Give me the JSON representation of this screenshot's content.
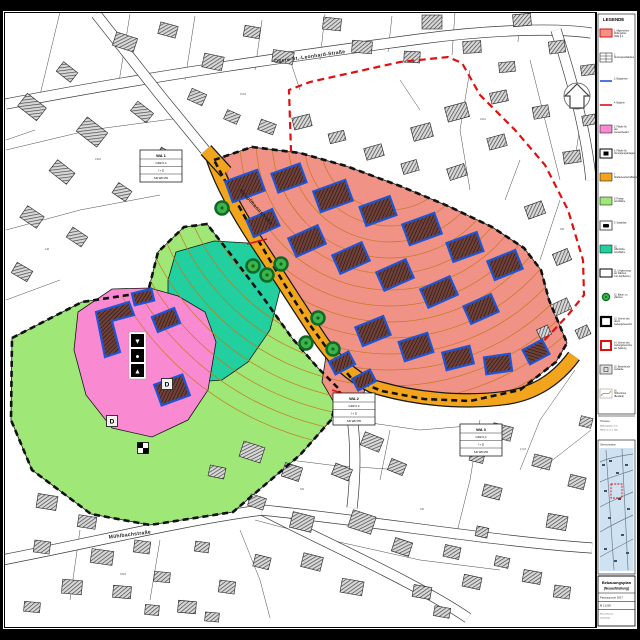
{
  "document": {
    "title": "Bebauungsplan",
    "subtitle": "(Neuaufstellung)",
    "version": "Fassung vom 2017",
    "scale": "M 1:1000",
    "footer": [
      "Planverfasser",
      "Gemeinde"
    ]
  },
  "legend": {
    "title": "LEGENDE",
    "items": [
      {
        "type": "wa",
        "label": "1. Allgemeines Wohngebiet (WA) § 4 BauNVO"
      },
      {
        "type": "table",
        "label": "2. Nutzungsschablone"
      },
      {
        "type": "blueline",
        "label": "3. Baugrenze"
      },
      {
        "type": "redline",
        "label": "4. Baulinie"
      },
      {
        "type": "pink",
        "label": "5. Fläche für den Gemeinbedarf"
      },
      {
        "type": "blackbox",
        "label": "6. Fläche für Versorgungsanlagen"
      },
      {
        "type": "orange",
        "label": "7. Straßenverkehrsfläche"
      },
      {
        "type": "green",
        "label": "8. Private Grünfläche"
      },
      {
        "type": "playbox",
        "label": "9. Spielplatz"
      },
      {
        "type": "teal",
        "label": "10. Öffentliche Grünfläche"
      },
      {
        "type": "whitebox",
        "label": "11. Umgrenzung der Flächen zum Anpflanzen"
      },
      {
        "type": "tree",
        "label": "12. Baum, zu pflanzen"
      },
      {
        "type": "blackframe",
        "label": "13. Grenze des räuml. Geltungsbereichs"
      },
      {
        "type": "redframe",
        "label": "14. Grenze des Geltungsbereichs der Satzung"
      },
      {
        "type": "graybox",
        "label": "15. Bestehende Gebäude"
      },
      {
        "type": "contour",
        "label": "16. Höhenlinien (Bestand)"
      }
    ]
  },
  "notes": {
    "lines": [
      "Hinweise:",
      "Maßangaben in m.",
      "Höhen in m ü. NN."
    ]
  },
  "overview": {
    "title": "Übersichtsplan"
  },
  "map": {
    "colors": {
      "wa": "#f19286",
      "pink": "#f98ad2",
      "green": "#9fe878",
      "teal": "#22cf9e",
      "road": "#f2a51c",
      "contour": "#c8761c",
      "building_outline": "#1e55d6",
      "building_fill": "#6e4038",
      "existing_fill": "#d8d8d8",
      "boundary_black": "#111111",
      "boundary_red": "#dd1111",
      "tree_fill": "#3db34a",
      "tree_ring": "#0c6b26",
      "overview_bg": "#cfe2f2"
    },
    "streets": [
      {
        "name": "Obere-St.-Leonhard-Straße",
        "x": 310,
        "y": 58,
        "rot": -8
      },
      {
        "name": "Hauptmannstraße",
        "x": 255,
        "y": 208,
        "rot": 48
      },
      {
        "name": "Mühlbachstraße",
        "x": 130,
        "y": 536,
        "rot": -7
      }
    ],
    "wa_tables": [
      {
        "label": "WA 1",
        "rows": [
          "GRZ 0,4",
          "I + D",
          "SD WD PD"
        ],
        "x": 140,
        "y": 150
      },
      {
        "label": "WA 2",
        "rows": [
          "GRZ 0,4",
          "I + D",
          "SD WD PD"
        ],
        "x": 333,
        "y": 393
      },
      {
        "label": "WA 3",
        "rows": [
          "GRZ 0,4",
          "I + D",
          "SD WD PD"
        ],
        "x": 460,
        "y": 424
      }
    ],
    "d_labels": [
      {
        "t": "D",
        "x": 112,
        "y": 421
      },
      {
        "t": "D",
        "x": 167,
        "y": 384
      }
    ],
    "parcel_labels": [
      {
        "t": "146/2",
        "x": 95,
        "y": 160
      },
      {
        "t": "148",
        "x": 45,
        "y": 250
      },
      {
        "t": "151/3",
        "x": 240,
        "y": 95
      },
      {
        "t": "162/1",
        "x": 480,
        "y": 120
      },
      {
        "t": "168",
        "x": 560,
        "y": 230
      },
      {
        "t": "171/2",
        "x": 520,
        "y": 450
      },
      {
        "t": "329",
        "x": 300,
        "y": 490
      },
      {
        "t": "333/4",
        "x": 120,
        "y": 575
      },
      {
        "t": "340",
        "x": 420,
        "y": 510
      },
      {
        "t": "155",
        "x": 30,
        "y": 330
      }
    ],
    "symbols": {
      "utility_glyphs": [
        "▼",
        "●",
        "▲"
      ],
      "utility_x": 131,
      "utility_y": 334,
      "checker_x": 143,
      "checker_y": 448
    },
    "zones": [
      {
        "name": "gruenflaeche",
        "color": "green",
        "contours": true,
        "points": "12,338 82,302 148,292 158,252 184,227 207,224 232,256 262,296 292,338 318,368 340,390 331,420 300,455 233,512 150,525 91,514 32,470 11,420"
      },
      {
        "name": "oeffentliche-gruenflaeche",
        "color": "teal",
        "contours": false,
        "points": "176,252 214,241 248,243 272,258 280,290 270,330 248,362 222,380 196,382 176,360 168,318 168,280"
      },
      {
        "name": "gemeinbedarf",
        "color": "pink",
        "contours": false,
        "points": "78,312 112,289 150,288 178,296 205,312 216,342 208,390 188,420 152,437 112,428 86,395 74,350"
      },
      {
        "name": "wohngebiet",
        "color": "wa",
        "contours": true,
        "points": "214,160 252,147 300,153 346,166 400,186 448,206 492,227 524,248 541,270 549,300 567,343 556,362 520,390 470,401 424,399 382,391 352,379 331,354 310,325 291,295 271,262 251,228 231,192"
      },
      {
        "name": "wohngebiet-sued",
        "color": "wa",
        "contours": true,
        "points": "326,356 355,372 366,382 362,404 336,406 322,382"
      }
    ],
    "orange_road": [
      "M 213,159 C 222,185 238,214 258,244 C 278,274 298,306 322,342 C 338,364 352,376 372,386 C 410,398 460,404 505,398 C 535,394 558,378 574,356",
      "M 206,150 L 226,172"
    ],
    "base_roads": [
      "M 6,104 C 150,76 300,55 420,39 C 480,31 550,27 591,33",
      "M 96,14 L 160,95 L 205,150",
      "M 556,30 C 572,80 586,130 591,180",
      "M 2,560 C 100,541 180,521 262,510 C 330,545 420,585 468,618",
      "M 262,510 C 380,522 500,542 592,548",
      "M 346,380 C 354,420 358,455 352,508"
    ],
    "boundary_black": [
      "214,160 252,147 300,153 346,166 400,186 448,206 492,227 524,248 541,270 549,300 567,343 556,362 520,390 470,401 424,399 382,391 352,379 331,354 310,325 291,295 271,262 251,228 231,192",
      "12,338 82,302 148,292 158,252 184,227 207,224 232,256 262,296 292,338 318,368 340,390 331,420 300,455 233,512 150,525 91,514 32,470 11,420"
    ],
    "boundary_red": "M 291,152 L 289,90 L 310,82 L 355,72 L 400,62 L 448,57 L 462,63 L 480,95 L 515,130 L 545,165 L 568,210 L 583,260 L 584,295 L 568,315 L 552,332 L 540,345",
    "red_lines": [
      [
        247,
        244,
        267,
        239
      ],
      [
        332,
        390,
        350,
        396
      ]
    ],
    "proposed_buildings": [
      [
        245,
        186,
        34,
        22,
        -20
      ],
      [
        289,
        178,
        30,
        20,
        -20
      ],
      [
        333,
        196,
        34,
        22,
        -20
      ],
      [
        378,
        211,
        32,
        20,
        -20
      ],
      [
        422,
        229,
        34,
        22,
        -20
      ],
      [
        465,
        247,
        32,
        20,
        -20
      ],
      [
        505,
        265,
        30,
        20,
        -22
      ],
      [
        263,
        223,
        28,
        18,
        -24
      ],
      [
        307,
        241,
        32,
        20,
        -24
      ],
      [
        351,
        258,
        32,
        20,
        -24
      ],
      [
        395,
        275,
        32,
        20,
        -24
      ],
      [
        439,
        292,
        32,
        20,
        -24
      ],
      [
        481,
        309,
        30,
        19,
        -24
      ],
      [
        373,
        331,
        30,
        20,
        -22
      ],
      [
        416,
        347,
        30,
        20,
        -18
      ],
      [
        458,
        358,
        28,
        18,
        -14
      ],
      [
        498,
        364,
        26,
        17,
        -8
      ],
      [
        536,
        352,
        16,
        22,
        62
      ],
      [
        342,
        363,
        22,
        14,
        -28
      ],
      [
        364,
        380,
        20,
        13,
        -28
      ],
      [
        143,
        297,
        20,
        12,
        -14
      ],
      [
        166,
        320,
        24,
        16,
        -22
      ],
      [
        172,
        390,
        30,
        22,
        -20
      ]
    ],
    "proposed_polys": [
      "96,312 129,302 134,315 112,321 120,352 105,357"
    ],
    "trees": [
      [
        222,
        208
      ],
      [
        253,
        266
      ],
      [
        267,
        275
      ],
      [
        281,
        264
      ],
      [
        318,
        318
      ],
      [
        306,
        343
      ],
      [
        333,
        349
      ]
    ],
    "existing_buildings": [
      [
        125,
        42,
        22,
        14,
        18
      ],
      [
        168,
        30,
        18,
        12,
        15
      ],
      [
        213,
        62,
        20,
        14,
        12
      ],
      [
        252,
        32,
        16,
        11,
        10
      ],
      [
        283,
        57,
        21,
        12,
        8
      ],
      [
        332,
        24,
        18,
        12,
        6
      ],
      [
        362,
        47,
        20,
        12,
        5
      ],
      [
        412,
        57,
        16,
        11,
        3
      ],
      [
        432,
        22,
        20,
        14,
        0
      ],
      [
        472,
        47,
        18,
        12,
        -3
      ],
      [
        507,
        67,
        16,
        10,
        -5
      ],
      [
        522,
        20,
        18,
        12,
        -5
      ],
      [
        557,
        47,
        16,
        12,
        -8
      ],
      [
        588,
        70,
        14,
        10,
        -8
      ],
      [
        32,
        107,
        24,
        16,
        38
      ],
      [
        67,
        72,
        18,
        12,
        38
      ],
      [
        92,
        132,
        26,
        18,
        38
      ],
      [
        142,
        112,
        20,
        12,
        38
      ],
      [
        62,
        172,
        22,
        14,
        38
      ],
      [
        32,
        217,
        20,
        14,
        34
      ],
      [
        77,
        237,
        18,
        12,
        34
      ],
      [
        122,
        192,
        16,
        12,
        34
      ],
      [
        22,
        272,
        18,
        12,
        30
      ],
      [
        165,
        155,
        14,
        10,
        30
      ],
      [
        197,
        97,
        16,
        12,
        24
      ],
      [
        232,
        117,
        14,
        10,
        24
      ],
      [
        267,
        127,
        16,
        11,
        20
      ],
      [
        302,
        122,
        18,
        12,
        -14
      ],
      [
        337,
        137,
        16,
        10,
        -14
      ],
      [
        374,
        152,
        18,
        12,
        -16
      ],
      [
        410,
        167,
        16,
        11,
        -16
      ],
      [
        422,
        132,
        20,
        14,
        -15
      ],
      [
        457,
        172,
        18,
        12,
        -18
      ],
      [
        457,
        112,
        22,
        15,
        -15
      ],
      [
        497,
        142,
        18,
        12,
        -15
      ],
      [
        499,
        97,
        17,
        11,
        -12
      ],
      [
        541,
        112,
        16,
        12,
        -10
      ],
      [
        572,
        157,
        17,
        12,
        -8
      ],
      [
        589,
        120,
        13,
        10,
        -10
      ],
      [
        535,
        210,
        18,
        13,
        -20
      ],
      [
        562,
        257,
        16,
        12,
        -22
      ],
      [
        561,
        307,
        18,
        12,
        -25
      ],
      [
        583,
        332,
        13,
        10,
        -25
      ],
      [
        544,
        332,
        12,
        10,
        -25
      ],
      [
        502,
        432,
        20,
        14,
        14
      ],
      [
        542,
        462,
        18,
        12,
        14
      ],
      [
        577,
        482,
        16,
        12,
        14
      ],
      [
        492,
        492,
        18,
        12,
        14
      ],
      [
        557,
        522,
        20,
        14,
        10
      ],
      [
        586,
        422,
        12,
        10,
        14
      ],
      [
        477,
        457,
        14,
        10,
        14
      ],
      [
        532,
        577,
        18,
        12,
        10
      ],
      [
        562,
        592,
        16,
        12,
        8
      ],
      [
        502,
        562,
        14,
        10,
        12
      ],
      [
        252,
        452,
        22,
        16,
        18
      ],
      [
        292,
        472,
        18,
        14,
        18
      ],
      [
        257,
        502,
        16,
        12,
        18
      ],
      [
        302,
        522,
        22,
        16,
        14
      ],
      [
        342,
        472,
        18,
        12,
        22
      ],
      [
        372,
        442,
        20,
        14,
        22
      ],
      [
        397,
        467,
        16,
        12,
        22
      ],
      [
        362,
        522,
        24,
        18,
        18
      ],
      [
        402,
        547,
        18,
        14,
        18
      ],
      [
        312,
        562,
        20,
        14,
        14
      ],
      [
        262,
        562,
        16,
        12,
        14
      ],
      [
        352,
        587,
        22,
        14,
        10
      ],
      [
        422,
        592,
        18,
        12,
        10
      ],
      [
        452,
        552,
        16,
        12,
        12
      ],
      [
        442,
        612,
        16,
        10,
        10
      ],
      [
        472,
        582,
        18,
        12,
        12
      ],
      [
        482,
        532,
        12,
        10,
        12
      ],
      [
        47,
        502,
        20,
        14,
        9
      ],
      [
        87,
        522,
        18,
        12,
        9
      ],
      [
        42,
        547,
        16,
        12,
        8
      ],
      [
        102,
        557,
        22,
        14,
        8
      ],
      [
        142,
        547,
        16,
        12,
        8
      ],
      [
        72,
        587,
        20,
        14,
        5
      ],
      [
        122,
        592,
        18,
        12,
        5
      ],
      [
        162,
        577,
        16,
        10,
        5
      ],
      [
        32,
        607,
        16,
        10,
        5
      ],
      [
        187,
        607,
        18,
        12,
        5
      ],
      [
        202,
        547,
        14,
        10,
        8
      ],
      [
        227,
        587,
        16,
        12,
        8
      ],
      [
        152,
        610,
        14,
        10,
        5
      ],
      [
        217,
        472,
        16,
        11,
        12
      ],
      [
        212,
        617,
        14,
        9,
        5
      ]
    ],
    "parcel_lines": [
      "60,12 40,95",
      "130,14 118,88",
      "195,16 185,80",
      "262,20 255,70",
      "325,14 320,60",
      "392,16 388,52",
      "455,12 452,55",
      "520,14 518,42",
      "6,150 90,130 180,118",
      "6,230 80,210 160,195",
      "6,300 60,280",
      "470,70 460,130 470,190",
      "530,60 545,120 560,180",
      "585,90 575,160",
      "560,200 540,260",
      "575,370 540,420 520,470",
      "591,430 540,470",
      "480,420 470,480 455,540",
      "390,430 380,480",
      "240,530 260,580 270,618",
      "160,540 150,600",
      "80,530 70,600",
      "350,420 420,430 480,425",
      "250,455 330,465 400,470",
      "255,520 330,540 420,560 500,570",
      "35,130 6,140",
      "210,240 180,260",
      "420,110 400,80",
      "300,90 290,60",
      "505,200 520,160"
    ]
  }
}
